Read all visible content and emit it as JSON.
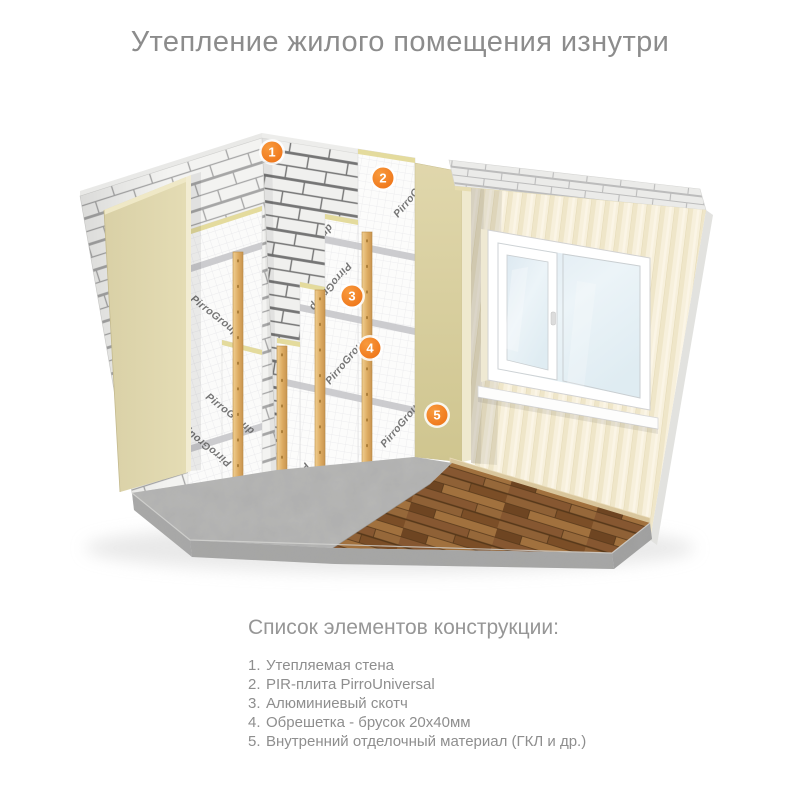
{
  "title": "Утепление жилого помещения изнутри",
  "illustration": {
    "brand": "PirroGroup",
    "markers": [
      {
        "number": "1"
      },
      {
        "number": "2"
      },
      {
        "number": "3"
      },
      {
        "number": "4"
      },
      {
        "number": "5"
      }
    ]
  },
  "legend": {
    "heading": "Список элементов конструкции:",
    "items": [
      {
        "num": "1.",
        "label": "Утепляемая стена"
      },
      {
        "num": "2.",
        "label": "PIR-плита PirroUniversal"
      },
      {
        "num": "3.",
        "label": "Алюминиевый скотч"
      },
      {
        "num": "4.",
        "label": "Обрешетка - брусок 20x40мм"
      },
      {
        "num": "5.",
        "label": "Внутренний отделочный материал (ГКЛ и др.)"
      }
    ]
  },
  "colors": {
    "accent_orange": "#f0811f",
    "text_gray": "#8c8c8c",
    "beige_panel": "#dcd3a4",
    "wood_batten": "#e0b274",
    "glass_blue": "#e2edf3"
  }
}
